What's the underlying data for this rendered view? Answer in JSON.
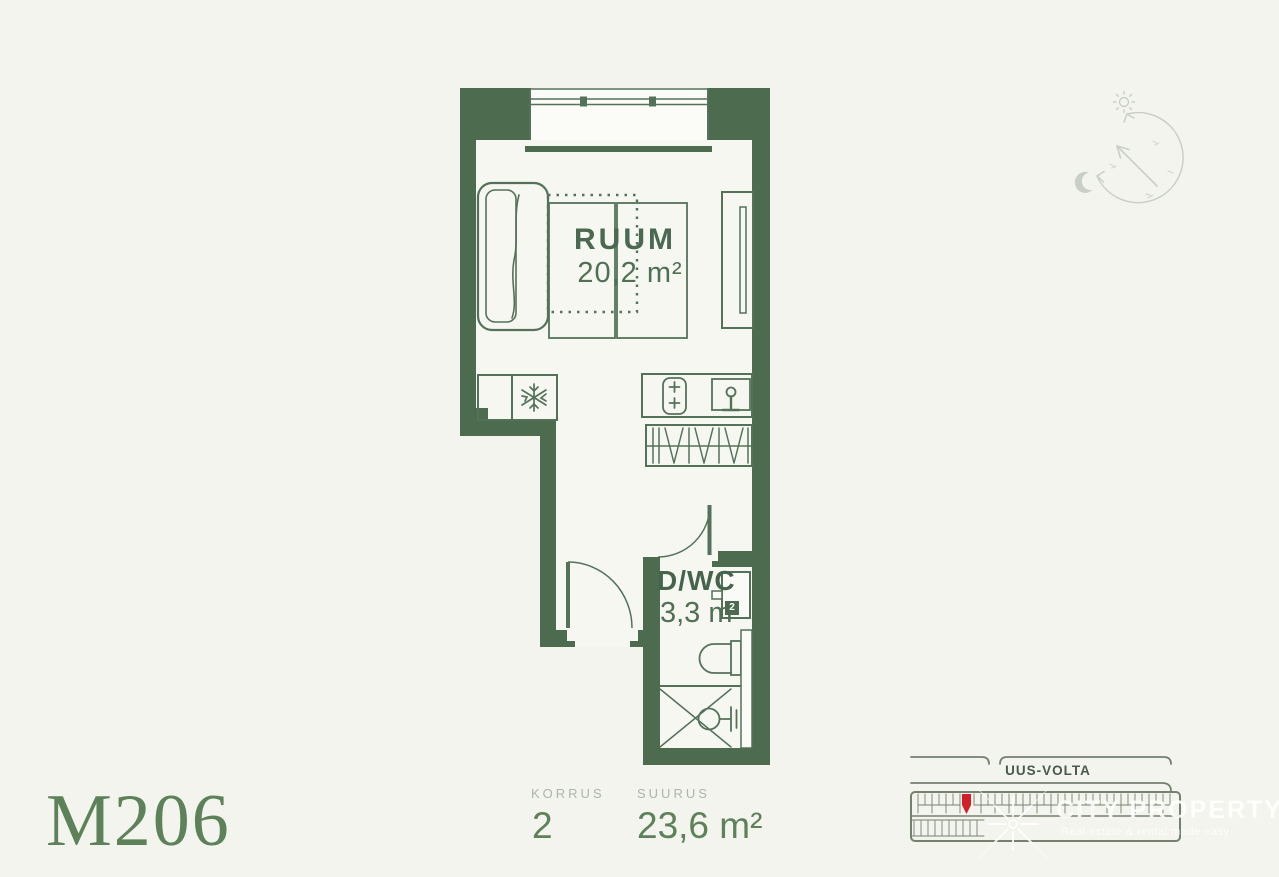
{
  "plan": {
    "unit_label": "M206",
    "room_label": "RUUM",
    "room_area": "20,2 m²",
    "bath_label": "D/WC",
    "bath_area": "3,3 m",
    "bath_area_sup": "2"
  },
  "footer": {
    "floor_label": "KORRUS",
    "floor_value": "2",
    "size_label": "SUURUS",
    "size_value": "23,6 m²"
  },
  "site": {
    "street_label": "UUS-VOLTA",
    "watermark_title": "CITY PROPERTY",
    "watermark_tagline": "Real estate & rental made easy"
  },
  "icons": {
    "fridge": "snowflake-icon",
    "kitchen": "stove-and-sink-icons",
    "bathroom": "toilet-and-shower-icons",
    "orientation": "sun-path-compass-with-sun-moon-and-north-arrow"
  },
  "colors": {
    "background": "#f2f4ed",
    "wall_green": "#4d6b4f",
    "accent_green": "#5d8159",
    "label_gray": "#adb5aa",
    "unit_highlight_red": "#d01f26",
    "site_line_gray": "#75806f",
    "compass_gray": "#c9cfc4",
    "watermark_white": "#ffffff"
  }
}
